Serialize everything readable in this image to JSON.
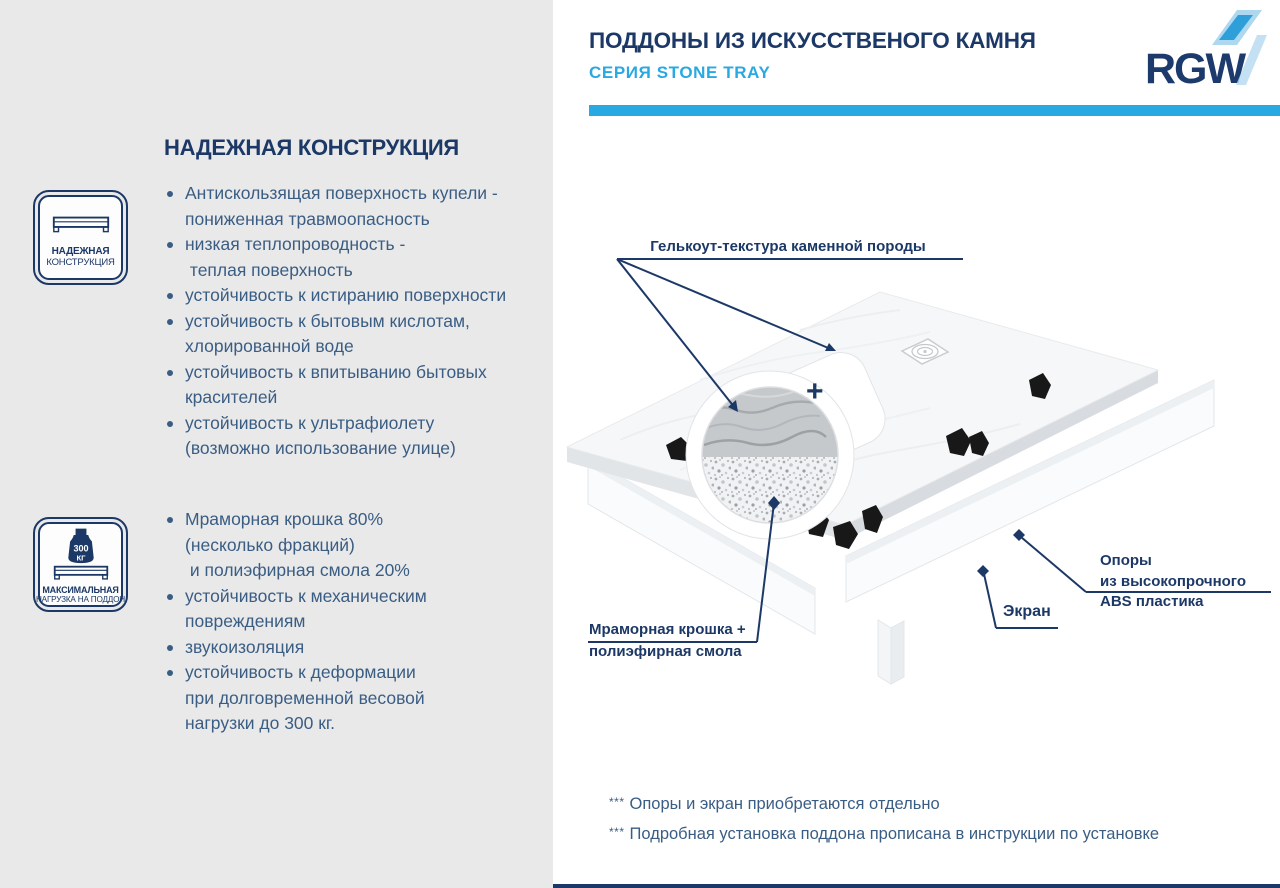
{
  "colors": {
    "navy": "#1c3866",
    "steel_blue": "#3a5d84",
    "light_blue": "#29a9e1",
    "panel_gray": "#e9e9e9",
    "logo_mid_blue": "#2f9fd9",
    "logo_light_blue": "#aed7f0"
  },
  "header": {
    "title": "ПОДДОНЫ ИЗ ИСКУССТВЕНОГО КАМНЯ",
    "subtitle": "СЕРИЯ STONE TRAY",
    "logo_text": "RGW"
  },
  "left_panel": {
    "heading": "НАДЕЖНАЯ КОНСТРУКЦИЯ",
    "badges": [
      {
        "icon": "tray-profile-icon",
        "line1": "НАДЕЖНАЯ",
        "line2": "КОНСТРУКЦИЯ"
      },
      {
        "icon": "weight-icon",
        "weight_value": "300",
        "weight_unit": "КГ",
        "line1": "МАКСИМАЛЬНАЯ",
        "line2": "НАГРУЗКА НА ПОДДОН"
      }
    ],
    "list1": [
      {
        "lines": [
          "Антискользящая поверхность купели -",
          "пониженная травмоопасность"
        ]
      },
      {
        "lines": [
          "низкая теплопроводность -",
          " теплая поверхность"
        ]
      },
      {
        "lines": [
          "устойчивость к истиранию поверхности"
        ]
      },
      {
        "lines": [
          "устойчивость к бытовым кислотам,",
          "хлорированной воде"
        ]
      },
      {
        "lines": [
          "устойчивость к впитыванию бытовых",
          "красителей"
        ]
      },
      {
        "lines": [
          "устойчивость к ультрафиолету",
          "(возможно использование улице)"
        ]
      }
    ],
    "list2": [
      {
        "lines": [
          "Мраморная крошка 80%",
          "(несколько фракций)",
          " и полиэфирная смола 20%"
        ]
      },
      {
        "lines": [
          "устойчивость к механическим",
          "повреждениям"
        ]
      },
      {
        "lines": [
          "звукоизоляция"
        ]
      },
      {
        "lines": [
          "устойчивость к деформации",
          "при долговременной весовой",
          "нагрузки до 300 кг."
        ]
      }
    ]
  },
  "diagram": {
    "labels": {
      "gelcoat": "Гелькоут-текстура каменной породы",
      "marble_line1": "Мраморная крошка +",
      "marble_line2": "полиэфирная смола",
      "supports_line1": "Опоры",
      "supports_line2": "из высокопрочного",
      "supports_line3": "ABS пластика",
      "screen": "Экран",
      "plus_sign": "+"
    }
  },
  "footnotes": [
    {
      "marker": "***",
      "text": "Опоры и экран приобретаются отдельно"
    },
    {
      "marker": "***",
      "text": "Подробная установка поддона прописана в инструкции по установке"
    }
  ]
}
